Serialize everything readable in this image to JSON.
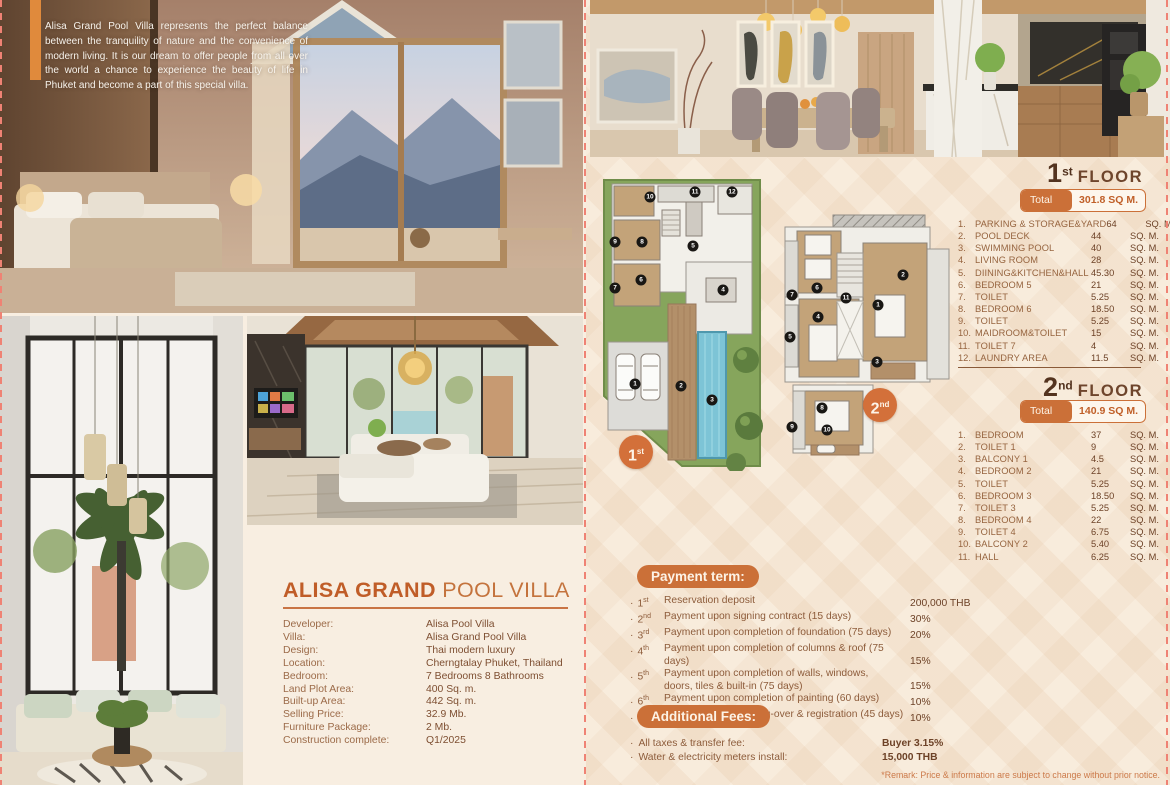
{
  "intro": {
    "text": "Alisa Grand Pool Villa represents the perfect balance between the tranquility of nature and the convenience of modern living. It is our dream to offer people from all over the world a chance to experience the beauty of life in Phuket and become a part of this special villa."
  },
  "villa": {
    "title_bold": "ALISA GRAND",
    "title_light": "POOL VILLA",
    "specs": [
      {
        "label": "Developer:",
        "value": "Alisa Pool Villa"
      },
      {
        "label": "Villa:",
        "value": "Alisa Grand Pool Villa"
      },
      {
        "label": "Design:",
        "value": "Thai modern luxury"
      },
      {
        "label": "Location:",
        "value": "Cherngtalay Phuket, Thailand"
      },
      {
        "label": "Bedroom:",
        "value": "7 Bedrooms 8 Bathrooms"
      },
      {
        "label": "Land Plot Area:",
        "value": "400 Sq. m."
      },
      {
        "label": "Built-up Area:",
        "value": "442 Sq. m."
      },
      {
        "label": "Selling Price:",
        "value": "32.9 Mb."
      },
      {
        "label": "Furniture Package:",
        "value": "2 Mb."
      },
      {
        "label": "Construction complete:",
        "value": "Q1/2025"
      }
    ]
  },
  "floors": [
    {
      "num": "1",
      "sup": "st",
      "word": "FLOOR",
      "total_label": "Total area",
      "total_value": "301.8 SQ M.",
      "badge_num": "1",
      "badge_sup": "st",
      "rooms": [
        {
          "n": "1.",
          "name": "PARKING & STORAGE&YARD",
          "area": "64",
          "unit": "SQ. M."
        },
        {
          "n": "2.",
          "name": "POOL DECK",
          "area": "44",
          "unit": "SQ. M."
        },
        {
          "n": "3.",
          "name": "SWIMMING POOL",
          "area": "40",
          "unit": "SQ. M."
        },
        {
          "n": "4.",
          "name": "LIVING ROOM",
          "area": "28",
          "unit": "SQ. M."
        },
        {
          "n": "5.",
          "name": "DIINING&KITCHEN&HALL",
          "area": "45.30",
          "unit": "SQ. M."
        },
        {
          "n": "6.",
          "name": "BEDROOM 5",
          "area": "21",
          "unit": "SQ. M."
        },
        {
          "n": "7.",
          "name": "TOILET",
          "area": "5.25",
          "unit": "SQ. M."
        },
        {
          "n": "8.",
          "name": "BEDROOM 6",
          "area": "18.50",
          "unit": "SQ. M."
        },
        {
          "n": "9.",
          "name": "TOILET",
          "area": "5.25",
          "unit": "SQ. M."
        },
        {
          "n": "10.",
          "name": "MAIDROOM&TOILET",
          "area": "15",
          "unit": "SQ. M."
        },
        {
          "n": "11.",
          "name": "TOILET 7",
          "area": "4",
          "unit": "SQ. M."
        },
        {
          "n": "12.",
          "name": "LAUNDRY AREA",
          "area": "11.5",
          "unit": "SQ. M."
        }
      ],
      "badges": [
        {
          "n": "1",
          "x": 37,
          "y": 208
        },
        {
          "n": "2",
          "x": 83,
          "y": 210
        },
        {
          "n": "3",
          "x": 114,
          "y": 224
        },
        {
          "n": "4",
          "x": 125,
          "y": 114
        },
        {
          "n": "5",
          "x": 95,
          "y": 70
        },
        {
          "n": "6",
          "x": 43,
          "y": 104
        },
        {
          "n": "7",
          "x": 17,
          "y": 112
        },
        {
          "n": "8",
          "x": 44,
          "y": 66
        },
        {
          "n": "9",
          "x": 17,
          "y": 66
        },
        {
          "n": "10",
          "x": 52,
          "y": 21
        },
        {
          "n": "11",
          "x": 97,
          "y": 16
        },
        {
          "n": "12",
          "x": 134,
          "y": 16
        }
      ]
    },
    {
      "num": "2",
      "sup": "nd",
      "word": "FLOOR",
      "total_label": "Total area",
      "total_value": "140.9 SQ M.",
      "badge_num": "2",
      "badge_sup": "nd",
      "rooms": [
        {
          "n": "1.",
          "name": "BEDROOM",
          "area": "37",
          "unit": "SQ. M."
        },
        {
          "n": "2.",
          "name": "TOILET 1",
          "area": "9",
          "unit": "SQ. M."
        },
        {
          "n": "3.",
          "name": "BALCONY 1",
          "area": "4.5",
          "unit": "SQ. M."
        },
        {
          "n": "4.",
          "name": "BEDROOM 2",
          "area": "21",
          "unit": "SQ. M."
        },
        {
          "n": "5.",
          "name": "TOILET",
          "area": "5.25",
          "unit": "SQ. M."
        },
        {
          "n": "6.",
          "name": "BEDROOM 3",
          "area": "18.50",
          "unit": "SQ. M."
        },
        {
          "n": "7.",
          "name": "TOILET 3",
          "area": "5.25",
          "unit": "SQ. M."
        },
        {
          "n": "8.",
          "name": "BEDROOM 4",
          "area": "22",
          "unit": "SQ. M."
        },
        {
          "n": "9.",
          "name": "TOILET 4",
          "area": "6.75",
          "unit": "SQ. M."
        },
        {
          "n": "10.",
          "name": "BALCONY 2",
          "area": "5.40",
          "unit": "SQ. M."
        },
        {
          "n": "11.",
          "name": "HALL",
          "area": "6.25",
          "unit": "SQ. M."
        }
      ],
      "badges": [
        {
          "n": "1",
          "x": 103,
          "y": 100
        },
        {
          "n": "2",
          "x": 128,
          "y": 70
        },
        {
          "n": "3",
          "x": 102,
          "y": 157
        },
        {
          "n": "4",
          "x": 43,
          "y": 112
        },
        {
          "n": "5",
          "x": 15,
          "y": 132
        },
        {
          "n": "6",
          "x": 42,
          "y": 83
        },
        {
          "n": "7",
          "x": 17,
          "y": 90
        },
        {
          "n": "8",
          "x": 47,
          "y": 203
        },
        {
          "n": "9",
          "x": 17,
          "y": 222
        },
        {
          "n": "10",
          "x": 52,
          "y": 225
        },
        {
          "n": "11",
          "x": 71,
          "y": 93
        }
      ]
    }
  ],
  "payment": {
    "header": "Payment term:",
    "items": [
      {
        "ord": "1",
        "sup": "st",
        "line1": "Reservation deposit",
        "line2": "",
        "value": "200,000 THB"
      },
      {
        "ord": "2",
        "sup": "nd",
        "line1": "Payment upon signing contract (15 days)",
        "line2": "",
        "value": "30%"
      },
      {
        "ord": "3",
        "sup": "rd",
        "line1": "Payment upon completion of foundation (75 days)",
        "line2": "",
        "value": "20%"
      },
      {
        "ord": "4",
        "sup": "th",
        "line1": "Payment upon completion of columns & roof (75 days)",
        "line2": "",
        "value": "15%"
      },
      {
        "ord": "5",
        "sup": "th",
        "line1": "Payment upon completion of walls, windows,",
        "line2": "doors, tiles & built-in (75 days)",
        "value": "15%"
      },
      {
        "ord": "6",
        "sup": "th",
        "line1": "Payment upon completion of painting (60 days)",
        "line2": "",
        "value": "10%"
      },
      {
        "ord": "7",
        "sup": "th",
        "line1": "Final payment handling-over & registration (45 days)",
        "line2": "",
        "value": "10%"
      }
    ]
  },
  "fees": {
    "header": "Additional Fees:",
    "items": [
      {
        "desc": "All taxes & transfer fee:",
        "value": "Buyer 3.15%"
      },
      {
        "desc": "Water & electricity meters install:",
        "value": "15,000 THB"
      }
    ],
    "remark": "*Remark: Price & information are subject to change without prior notice."
  },
  "colors": {
    "accent_orange": "#cb7038",
    "title_orange": "#c05d28",
    "text_brown": "#8d5c3b",
    "dark_brown": "#53331f",
    "cream_bg": "#f8eee1",
    "lawn_green": "#86a55c",
    "pool_blue": "#7dc4d6"
  }
}
